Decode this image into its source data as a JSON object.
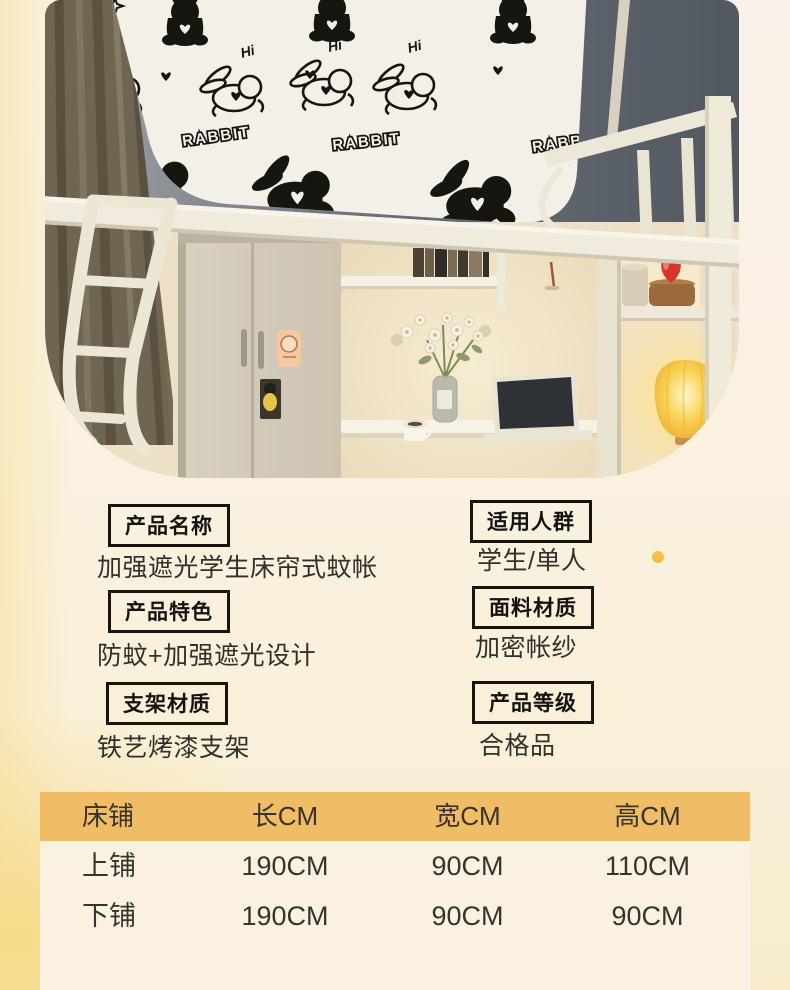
{
  "photo": {
    "pattern": {
      "brand_text": "RABBIT",
      "hi_text": "Hi"
    }
  },
  "specs": {
    "left": [
      {
        "label": "产品名称",
        "value": "加强遮光学生床帘式蚊帐"
      },
      {
        "label": "产品特色",
        "value": "防蚊+加强遮光设计"
      },
      {
        "label": "支架材质",
        "value": "铁艺烤漆支架"
      }
    ],
    "right": [
      {
        "label": "适用人群",
        "value": "学生/单人"
      },
      {
        "label": "面料材质",
        "value": "加密帐纱"
      },
      {
        "label": "产品等级",
        "value": "合格品"
      }
    ]
  },
  "size_table": {
    "columns": [
      "床铺",
      "长CM",
      "宽CM",
      "高CM"
    ],
    "rows": [
      {
        "bed": "上铺",
        "length": "190CM",
        "width": "90CM",
        "height": "110CM"
      },
      {
        "bed": "下铺",
        "length": "190CM",
        "width": "90CM",
        "height": "90CM"
      }
    ]
  },
  "colors": {
    "table_header_bg": "#F1BC66",
    "table_body_bg": "#FAF1E0",
    "accent_dot": "#EFC243",
    "text": "#32302A",
    "panel": "#F3F0E8",
    "canopy": "#5E6672",
    "curtain": "#6F6552",
    "frame_cream": "#EFEADA",
    "lamp_glow": "#FFE9A8"
  }
}
